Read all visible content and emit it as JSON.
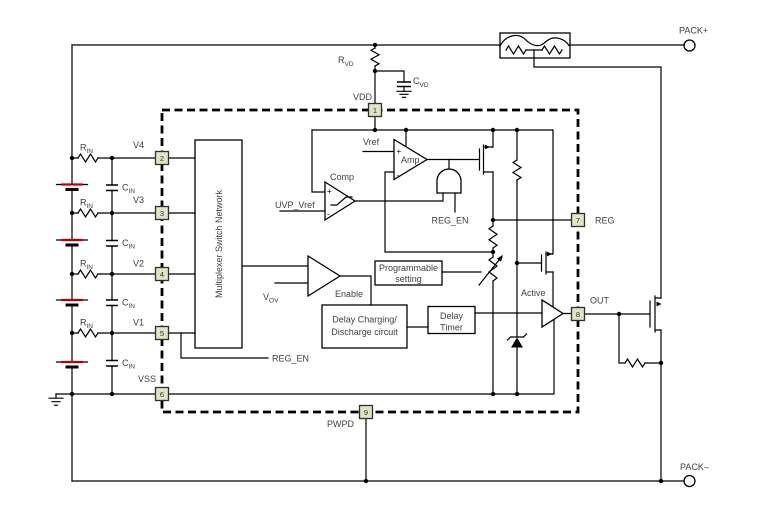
{
  "terminals": {
    "pack_plus": "PACK+",
    "pack_minus": "PACK–"
  },
  "components": {
    "r_vd": {
      "base": "R",
      "sub": "VD"
    },
    "c_vd": {
      "base": "C",
      "sub": "VD"
    },
    "r_in": {
      "base": "R",
      "sub": "IN"
    },
    "c_in": {
      "base": "C",
      "sub": "IN"
    }
  },
  "pins": [
    {
      "number": "1",
      "label": "VDD"
    },
    {
      "number": "2",
      "label": "V4"
    },
    {
      "number": "3",
      "label": "V3"
    },
    {
      "number": "4",
      "label": "V2"
    },
    {
      "number": "5",
      "label": "V1"
    },
    {
      "number": "6",
      "label": "VSS"
    },
    {
      "number": "7",
      "label": "REG"
    },
    {
      "number": "8",
      "label": "OUT"
    },
    {
      "number": "9",
      "label": "PWPD"
    }
  ],
  "ic": {
    "mux_label": "Multiplexer Switch Network",
    "comp": {
      "label": "Comp",
      "plus": "+",
      "minus": "-",
      "neg_input": "UVP_Vref"
    },
    "amp": {
      "label": "Amp",
      "plus": "+",
      "minus": "-",
      "pos_input": "Vref"
    },
    "and_gate_input": "REG_EN",
    "reg_en_tap": "REG_EN",
    "enable": {
      "label": "Enable",
      "input_base": "V",
      "input_sub": "OV"
    },
    "programmable": {
      "line1": "Programmable",
      "line2": "setting"
    },
    "delay_circuit": {
      "line1": "Delay Charging/",
      "line2": "Discharge circuit"
    },
    "delay_timer": {
      "line1": "Delay",
      "line2": "Timer"
    },
    "active_label": "Active"
  },
  "colors": {
    "line": "#000000",
    "text": "#404040",
    "pin_fill": "#dce6c3",
    "pin_border": "#2f2f2f",
    "battery_red": "#c00000"
  }
}
